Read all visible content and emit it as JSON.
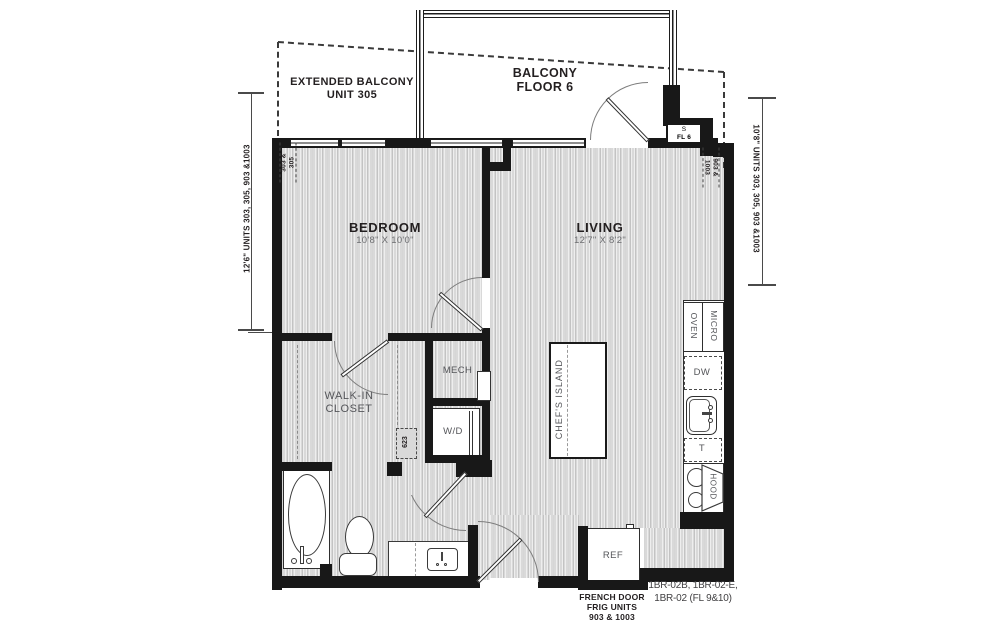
{
  "colors": {
    "wall": "#181818",
    "floor": "#d9d9d9",
    "text_dark": "#231f20",
    "text_gray": "#55565a"
  },
  "balcony": {
    "line1": "BALCONY",
    "line2": "FLOOR 6"
  },
  "extended_balcony": {
    "line1": "EXTENDED BALCONY",
    "line2": "UNIT 305"
  },
  "shaft": {
    "line1": "S",
    "line2": "FL 6"
  },
  "rooms": {
    "bedroom": {
      "name": "BEDROOM",
      "dims": "10'8\" X 10'0\""
    },
    "living": {
      "name": "LIVING",
      "dims": "12'7\" X 8'2\""
    },
    "walkin": {
      "line1": "WALK-IN",
      "line2": "CLOSET"
    },
    "mech": "MECH",
    "wd": "W/D"
  },
  "kitchen": {
    "island": "CHEF'S ISLAND",
    "oven": "OVEN",
    "micro": "MICRO",
    "dw": "DW",
    "t": "T",
    "hood": "HOOD",
    "ref": "REF"
  },
  "annotations": {
    "left_dim": "12'6\" UNITS 303, 305, 903 &1003",
    "right_dim": "10'8\" UNITS 303, 305, 903 &1003",
    "top_left_units": {
      "line1": "303 &",
      "line2": "305"
    },
    "top_right_units": {
      "line1": "903 &",
      "line2": "1003"
    },
    "closet_code": "623",
    "frig_note": {
      "line1": "FRENCH DOOR",
      "line2": "FRIG UNITS",
      "line3": "903 & 1003"
    },
    "plan_code": {
      "line1": "1BR-02B, 1BR-02-E,",
      "line2": "1BR-02 (FL 9&10)"
    }
  }
}
